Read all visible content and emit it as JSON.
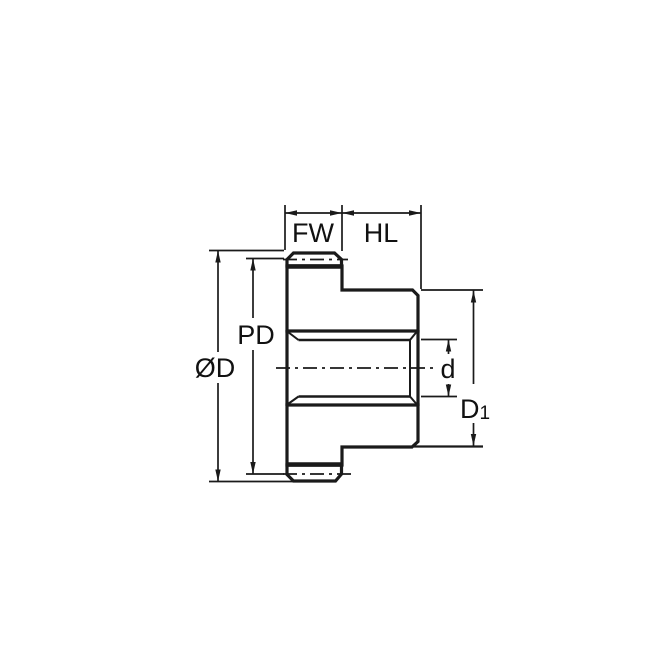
{
  "diagram": {
    "kind": "spur-gear-cross-section-dimension-drawing",
    "labels": {
      "face_width": "FW",
      "hub_length": "HL",
      "pitch_diameter": "PD",
      "outside_diameter": "ØD",
      "bore_diameter": "d",
      "hub_diameter_main": "D",
      "hub_diameter_sub": "1"
    },
    "colors": {
      "part_fill": "#c6e7f7",
      "tooth_fill": "#ffffff",
      "line": "#1a1a1a",
      "background": "#ffffff"
    }
  }
}
